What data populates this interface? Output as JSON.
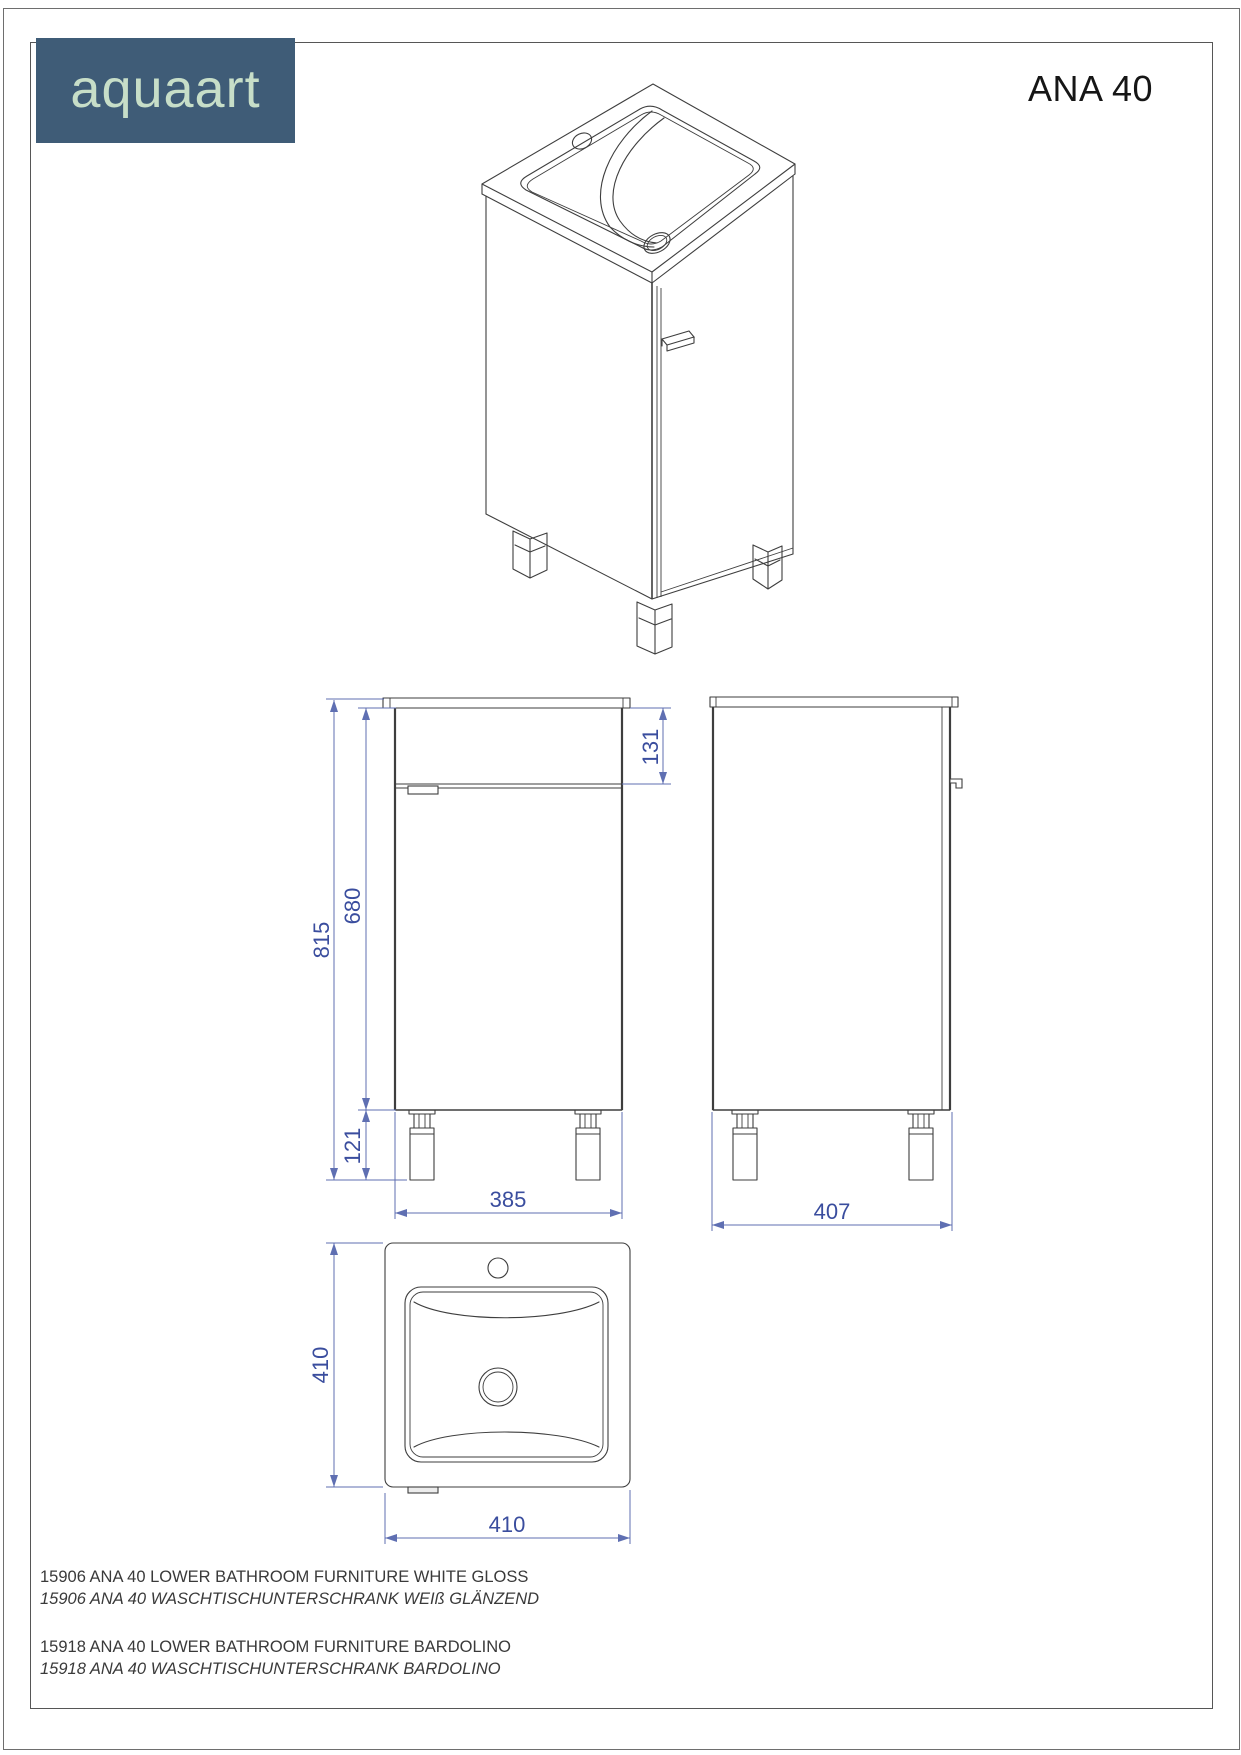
{
  "header": {
    "brand": "aquaart",
    "model": "ANA 40"
  },
  "dimensions": {
    "total_height": "815",
    "body_height": "680",
    "top_panel_height": "131",
    "leg_height": "121",
    "cabinet_width": "385",
    "side_depth": "407",
    "basin_depth": "410",
    "basin_width": "410"
  },
  "products": [
    {
      "en": "15906 ANA 40 LOWER BATHROOM FURNITURE WHITE GLOSS",
      "de": "15906 ANA 40 WASCHTISCHUNTERSCHRANK WEIß GLÄNZEND"
    },
    {
      "en": "15918 ANA 40 LOWER BATHROOM FURNITURE BARDOLINO",
      "de": "15918 ANA 40 WASCHTISCHUNTERSCHRANK BARDOLINO"
    }
  ],
  "colors": {
    "logo_background": "#3f5c77",
    "logo_text": "#c7dec8",
    "drawing_line": "#3e3e3e",
    "dimension_line": "#5f6fb2",
    "dimension_text": "#3a4d9e",
    "body_text": "#3a3a3a"
  }
}
